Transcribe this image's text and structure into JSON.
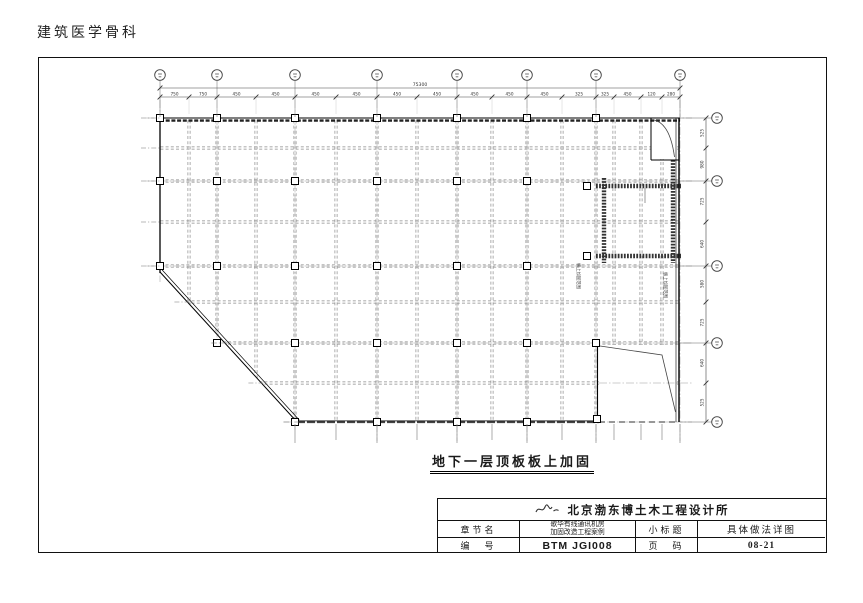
{
  "page": {
    "header_title": "建筑医学骨科"
  },
  "drawing": {
    "caption": "地下一层顶板板上加固",
    "plan": {
      "outline": [
        [
          160,
          118
        ],
        [
          680,
          118
        ],
        [
          680,
          422
        ],
        [
          297,
          422
        ],
        [
          160,
          272
        ]
      ],
      "grid_x": [
        160,
        189,
        217,
        256,
        295,
        336,
        377,
        417,
        457,
        492,
        527,
        562,
        596,
        614,
        641,
        662,
        680
      ],
      "grid_x_major": [
        160,
        217,
        295,
        377,
        457,
        527,
        596,
        680
      ],
      "grid_y": [
        118,
        148,
        181,
        222,
        266,
        302,
        343,
        383,
        422
      ],
      "grid_y_major": [
        118,
        181,
        266,
        343,
        422
      ],
      "total_dim": "75300",
      "dims_top": [
        "750",
        "750",
        "450",
        "450",
        "450",
        "450",
        "450",
        "450",
        "450",
        "450",
        "450",
        "325",
        "325",
        "450",
        "120",
        "280"
      ],
      "dims_right": [
        "525",
        "980",
        "725",
        "640",
        "580",
        "725",
        "640",
        "525"
      ],
      "squares": {
        "118": [
          160,
          217,
          295,
          377,
          457,
          527,
          596
        ],
        "181": [
          160,
          217,
          295,
          377,
          457,
          527
        ],
        "266": [
          160,
          217,
          295,
          377,
          457,
          527
        ],
        "343": [
          217,
          295,
          377,
          457,
          527,
          596
        ],
        "422": [
          295,
          377,
          457,
          527
        ]
      },
      "extra_squares": [
        [
          587,
          186
        ],
        [
          587,
          256
        ],
        [
          597,
          419
        ]
      ],
      "reinforced_box": {
        "x1": 604,
        "y1": 186,
        "x2": 673,
        "y2": 256
      },
      "annotations": [
        {
          "text": "板上加固范围",
          "x": 577,
          "y": 263
        },
        {
          "text": "板上加固范围",
          "x": 664,
          "y": 272
        }
      ]
    }
  },
  "title_block": {
    "company": "北京渤东博土木工程设计所",
    "chapter_label": "章节名",
    "project_line1": "歌华有线通讯机房",
    "project_line2": "加固改造工程案例",
    "subtitle_label": "小标题",
    "subtitle_value": "具体做法详图",
    "number_label": "编　号",
    "number_value": "BTM JGI008",
    "page_label": "页　码",
    "page_value": "08-21"
  }
}
